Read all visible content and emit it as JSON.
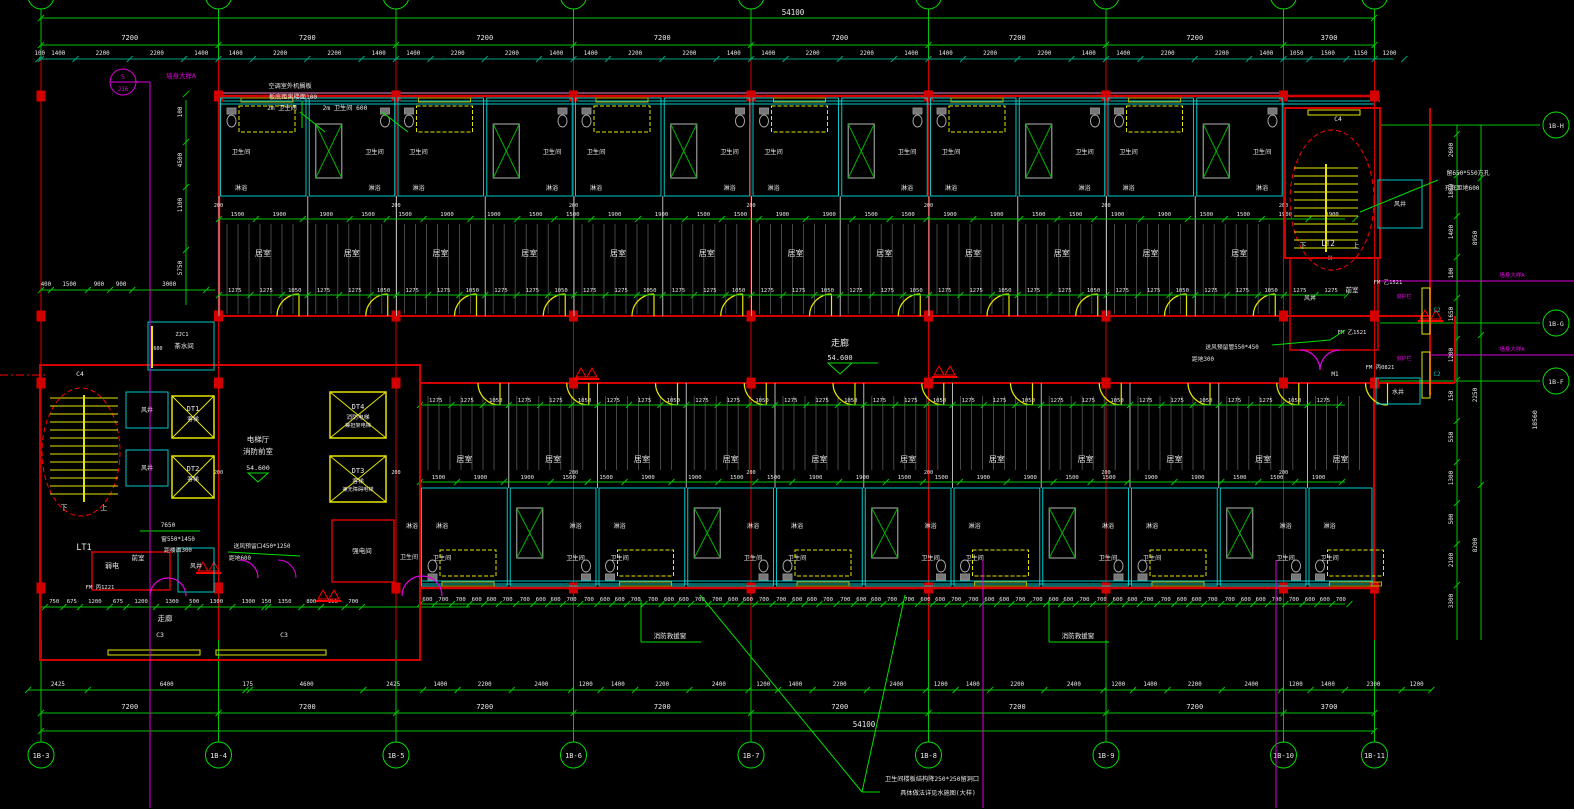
{
  "labels": {
    "bedroom": "居室",
    "toilet": "卫生间",
    "shower": "淋浴",
    "corridor": "走廊",
    "tea_room": "茶水间",
    "elev_hall": "电梯厅",
    "fire_lobby": "消防前室",
    "lobby": "前室",
    "weak_power": "弱电",
    "strong_power": "强电间",
    "air_shaft": "风井",
    "water_shaft": "水井",
    "down": "下",
    "up": "上",
    "stair1": "LT1",
    "stair2": "LT2",
    "h_mark": "H",
    "dt1": "DT1",
    "dt2": "DT2",
    "dt3": "DT3",
    "dt4": "DT4",
    "passenger": "客梯",
    "fire_elev": "消防电梯",
    "stretcher": "兼担架电梯",
    "accessible": "兼无障碍电梯",
    "c2": "C2",
    "c3": "C3",
    "c4": "C4",
    "m1": "M1",
    "zjc1": "ZJC1",
    "fm_yi1521": "FM 乙1521",
    "fm_bing1221": "FM 丙1221",
    "fm_bing0821": "FM 丙0821",
    "window_rail": "窗护栏",
    "level": "54.600",
    "rescue_window": "消防救援窗",
    "wall_detail": "墙身大样A"
  },
  "notes": {
    "ac1": "空调室外机搁板",
    "ac2": "板底距离楼面100",
    "wc2m_a": "2m 卫生间",
    "wc2m_b": "2m 卫生间 600",
    "vent_left1": "送风预留口450*1250",
    "vent_left2": "距地600",
    "vent_right1": "送风预留管550*450",
    "vent_right2": "距地300",
    "hole1": "留650*550方孔",
    "hole2": "孔底距地600",
    "d7650": "7650",
    "win1": "窗550*1450",
    "win2": "距楼面300",
    "slab1": "卫生间楼板结构降250*250留洞口",
    "slab2": "具体做法详见水施图(大样)"
  },
  "detail_bubble": {
    "num": "5",
    "sheet": "J16"
  },
  "grid": {
    "cols": [
      "1B-3",
      "1B-4",
      "1B-5",
      "1B-6",
      "1B-7",
      "1B-8",
      "1B-9",
      "1B-10",
      "1B-11"
    ],
    "rows": [
      "1B-H",
      "1B-G",
      "1B-F"
    ]
  },
  "dims": {
    "top_overall": "54100",
    "bottom_overall": "54100",
    "top_bays": [
      "7200",
      "7200",
      "7200",
      "7200",
      "7200",
      "7200",
      "7200",
      "3700"
    ],
    "bottom_bays": [
      "7200",
      "7200",
      "7200",
      "7200",
      "7200",
      "7200",
      "7200",
      "3700"
    ],
    "top_detail": [
      100,
      1400,
      2200,
      2200,
      1400,
      1400,
      2200,
      2200,
      1400,
      1400,
      2200,
      2200,
      1400,
      1400,
      2200,
      2200,
      1400,
      1400,
      2200,
      2200,
      1400,
      1400,
      2200,
      2200,
      1400,
      1400,
      2200,
      2200,
      1400,
      1050,
      1500,
      1150,
      1200
    ],
    "bottom_detail": [
      2425,
      6400,
      175,
      4600,
      2425,
      1400,
      2200,
      2400,
      1200,
      1400,
      2200,
      2400,
      1200,
      1400,
      2200,
      2400,
      1200,
      1400,
      2200,
      2400,
      1200,
      1400,
      2200,
      2400,
      1200,
      1400,
      2300,
      1200
    ],
    "corridor_cycle": [
      1275,
      1275,
      1050
    ],
    "room_cycle": [
      1500,
      1900,
      1900,
      1500
    ],
    "grid_gap": "200",
    "bath_cycle": [
      600,
      700,
      700,
      600
    ],
    "wing_bottom": [
      750,
      675,
      1200,
      675,
      1200,
      1300,
      500,
      1300,
      1300,
      150,
      1350,
      800,
      956,
      700
    ],
    "wing_left": [
      400,
      1500,
      900,
      900,
      3000
    ],
    "left_col": [
      "100",
      "4500",
      "1100",
      "5750"
    ],
    "right_colA": [
      "2600",
      "1800",
      "1400",
      "100",
      "1650",
      "1200",
      "150",
      "550",
      "1300",
      "500",
      "2100",
      "3300"
    ],
    "right_colB": [
      "8950",
      "2250",
      "8200"
    ],
    "right_colC": [
      "18560"
    ]
  }
}
